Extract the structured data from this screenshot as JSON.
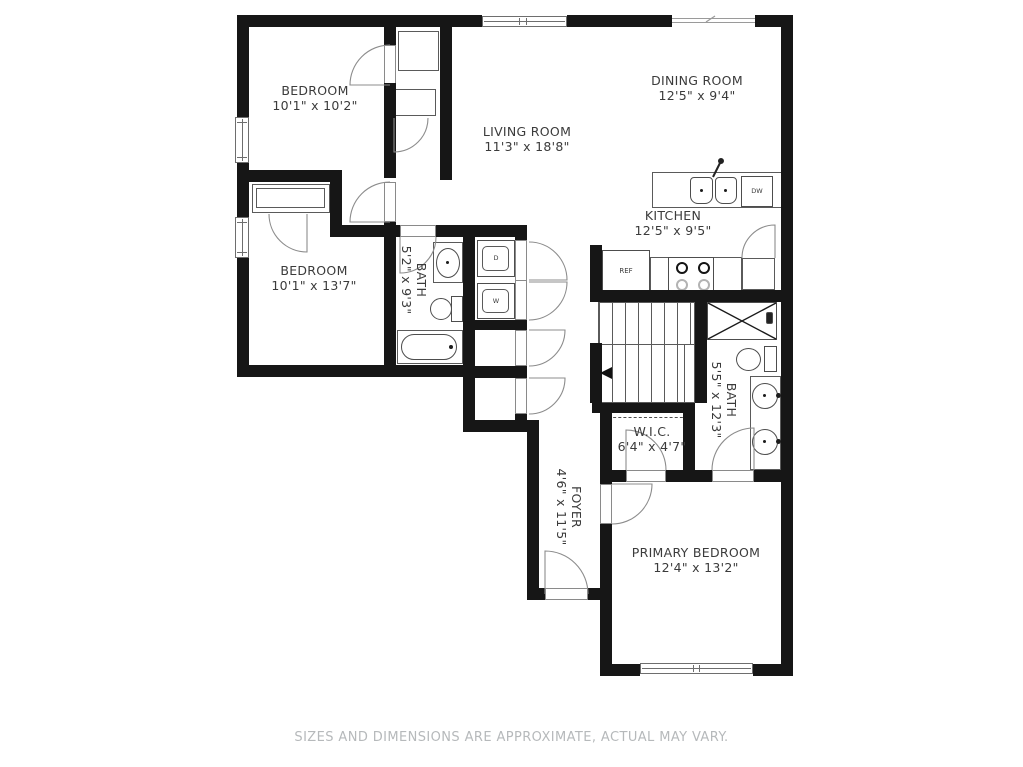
{
  "rooms": {
    "living_room": {
      "name": "LIVING ROOM",
      "dims": "11'3\" x 18'8\""
    },
    "dining_room": {
      "name": "DINING ROOM",
      "dims": "12'5\" x 9'4\""
    },
    "kitchen": {
      "name": "KITCHEN",
      "dims": "12'5\" x 9'5\""
    },
    "bedroom_1": {
      "name": "BEDROOM",
      "dims": "10'1\" x 10'2\""
    },
    "bedroom_2": {
      "name": "BEDROOM",
      "dims": "10'1\" x 13'7\""
    },
    "bath_1": {
      "name": "BATH",
      "dims": "5'2\" x 9'3\""
    },
    "bath_2": {
      "name": "BATH",
      "dims": "5'5\" x 12'3\""
    },
    "wic": {
      "name": "W.I.C.",
      "dims": "6'4\" x 4'7\""
    },
    "foyer": {
      "name": "FOYER",
      "dims": "4'6\" x 11'5\""
    },
    "primary_bedroom": {
      "name": "PRIMARY BEDROOM",
      "dims": "12'4\" x 13'2\""
    }
  },
  "appliances": {
    "refrigerator": "REF",
    "dishwasher": "DW",
    "dryer": "D",
    "washer": "W"
  },
  "footer": {
    "disclaimer": "SIZES AND DIMENSIONS ARE APPROXIMATE, ACTUAL MAY VARY."
  },
  "colors": {
    "wall": "#161616",
    "room_label": "#3b3b3b",
    "fixture_outline": "#4d4d4d",
    "disclaimer_text": "#b6b9bb",
    "background": "#ffffff"
  }
}
